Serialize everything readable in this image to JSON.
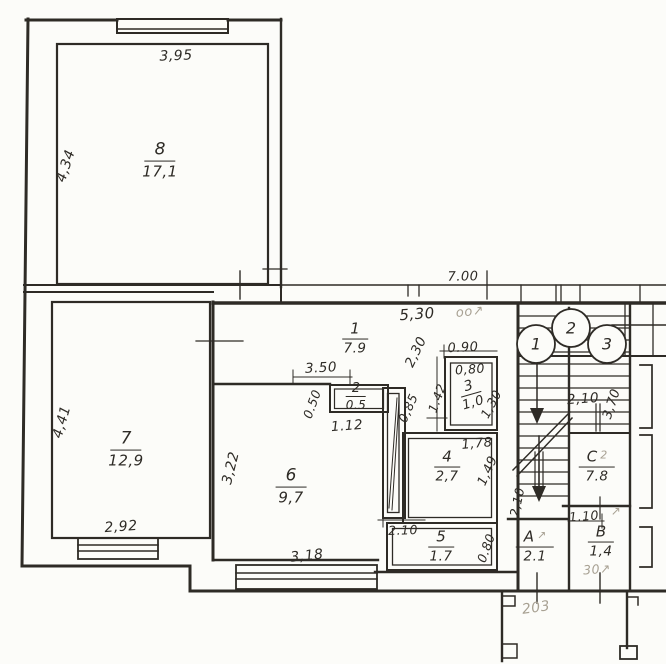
{
  "meta": {
    "type": "apartment-floor-plan"
  },
  "colors": {
    "ink": "#2e2b26",
    "pencil": "#a8a193",
    "paper": "#fcfcf9"
  },
  "rooms": {
    "r1": {
      "num": "1",
      "area": "7.9"
    },
    "r2": {
      "num": "2",
      "area": "0.5"
    },
    "r3": {
      "num": "3",
      "area": "1,0"
    },
    "r4": {
      "num": "4",
      "area": "2,7"
    },
    "r5": {
      "num": "5",
      "area": "1.7"
    },
    "r6": {
      "num": "6",
      "area": "9,7"
    },
    "r7": {
      "num": "7",
      "area": "12,9"
    },
    "r8": {
      "num": "8",
      "area": "17,1"
    },
    "rA": {
      "num": "A",
      "area": "2.1"
    },
    "rB": {
      "num": "B",
      "area": "1,4"
    },
    "rC": {
      "num": "C",
      "area": "7.8"
    }
  },
  "dims": {
    "room8_width": "3,95",
    "room8_height": "4,34",
    "room7_height": "4,41",
    "room7_width": "2,92",
    "room6_height": "3,22",
    "room6_width": "3,18",
    "hall_width": "5,30",
    "hall_depth": "2,30",
    "closet2_span": "3.50",
    "closet2_depth": "0.50",
    "closet2_width": "1.12",
    "closet_door": "0,85",
    "closet_height": "2.10",
    "wc_top": "0.90",
    "wc_inner": "0,80",
    "wc_left": "1.42",
    "wc_right": "1,30",
    "bath_width": "1,78",
    "bath_height": "1,49",
    "room5_right": "0.80",
    "top_total": "7.00",
    "stairs_width": "2,10",
    "stairs_height": "3,70",
    "roomA_height": "2,10",
    "roomB_width": "1.10"
  },
  "markers": {
    "m1": "1",
    "m2": "2",
    "m3": "3"
  },
  "pencil": {
    "hall_note": "оо↗",
    "roomC_note": "2",
    "roomA_note": "↗",
    "roomB_note": "↗",
    "roomB_code": "30↗",
    "porch_note": "203"
  }
}
